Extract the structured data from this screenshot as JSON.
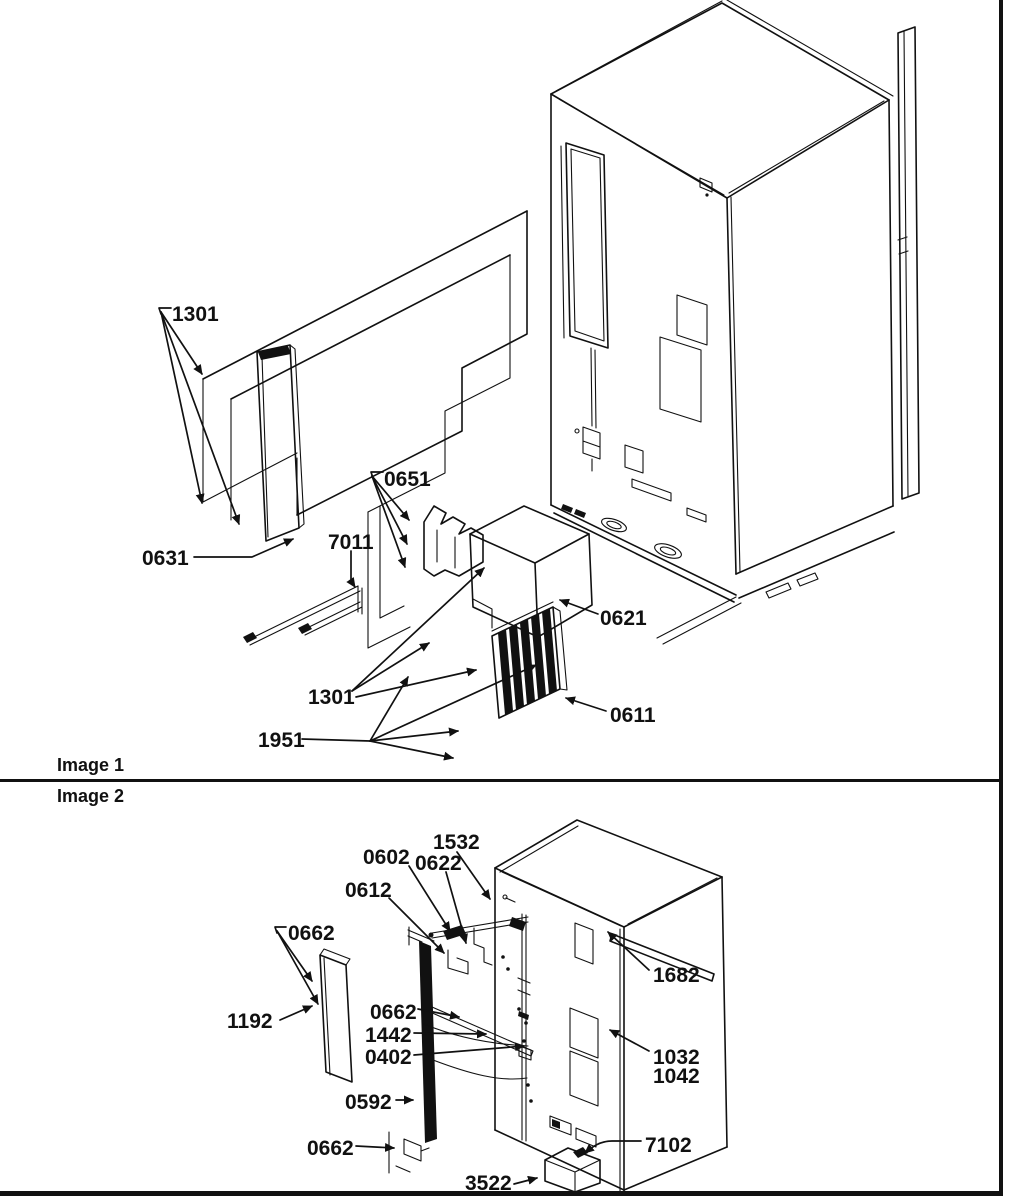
{
  "palette": {
    "ink": "#111111",
    "paper": "#ffffff"
  },
  "image1": {
    "title": "Image 1",
    "callouts": [
      {
        "id": "1301-top",
        "label": "1301"
      },
      {
        "id": "0631",
        "label": "0631"
      },
      {
        "id": "7011",
        "label": "7011"
      },
      {
        "id": "0651",
        "label": "0651"
      },
      {
        "id": "0621",
        "label": "0621"
      },
      {
        "id": "1301-bottom",
        "label": "1301"
      },
      {
        "id": "1951",
        "label": "1951"
      },
      {
        "id": "0611",
        "label": "0611"
      }
    ]
  },
  "image2": {
    "title": "Image 2",
    "callouts": [
      {
        "id": "1532",
        "label": "1532"
      },
      {
        "id": "0602",
        "label": "0602"
      },
      {
        "id": "0622",
        "label": "0622"
      },
      {
        "id": "0612",
        "label": "0612"
      },
      {
        "id": "0662-a",
        "label": "0662"
      },
      {
        "id": "1192",
        "label": "1192"
      },
      {
        "id": "0662-b",
        "label": "0662"
      },
      {
        "id": "1442",
        "label": "1442"
      },
      {
        "id": "0402",
        "label": "0402"
      },
      {
        "id": "0592",
        "label": "0592"
      },
      {
        "id": "0662-c",
        "label": "0662"
      },
      {
        "id": "3522",
        "label": "3522"
      },
      {
        "id": "1682",
        "label": "1682"
      },
      {
        "id": "1032",
        "label": "1032"
      },
      {
        "id": "1042",
        "label": "1042"
      },
      {
        "id": "7102",
        "label": "7102"
      }
    ]
  }
}
